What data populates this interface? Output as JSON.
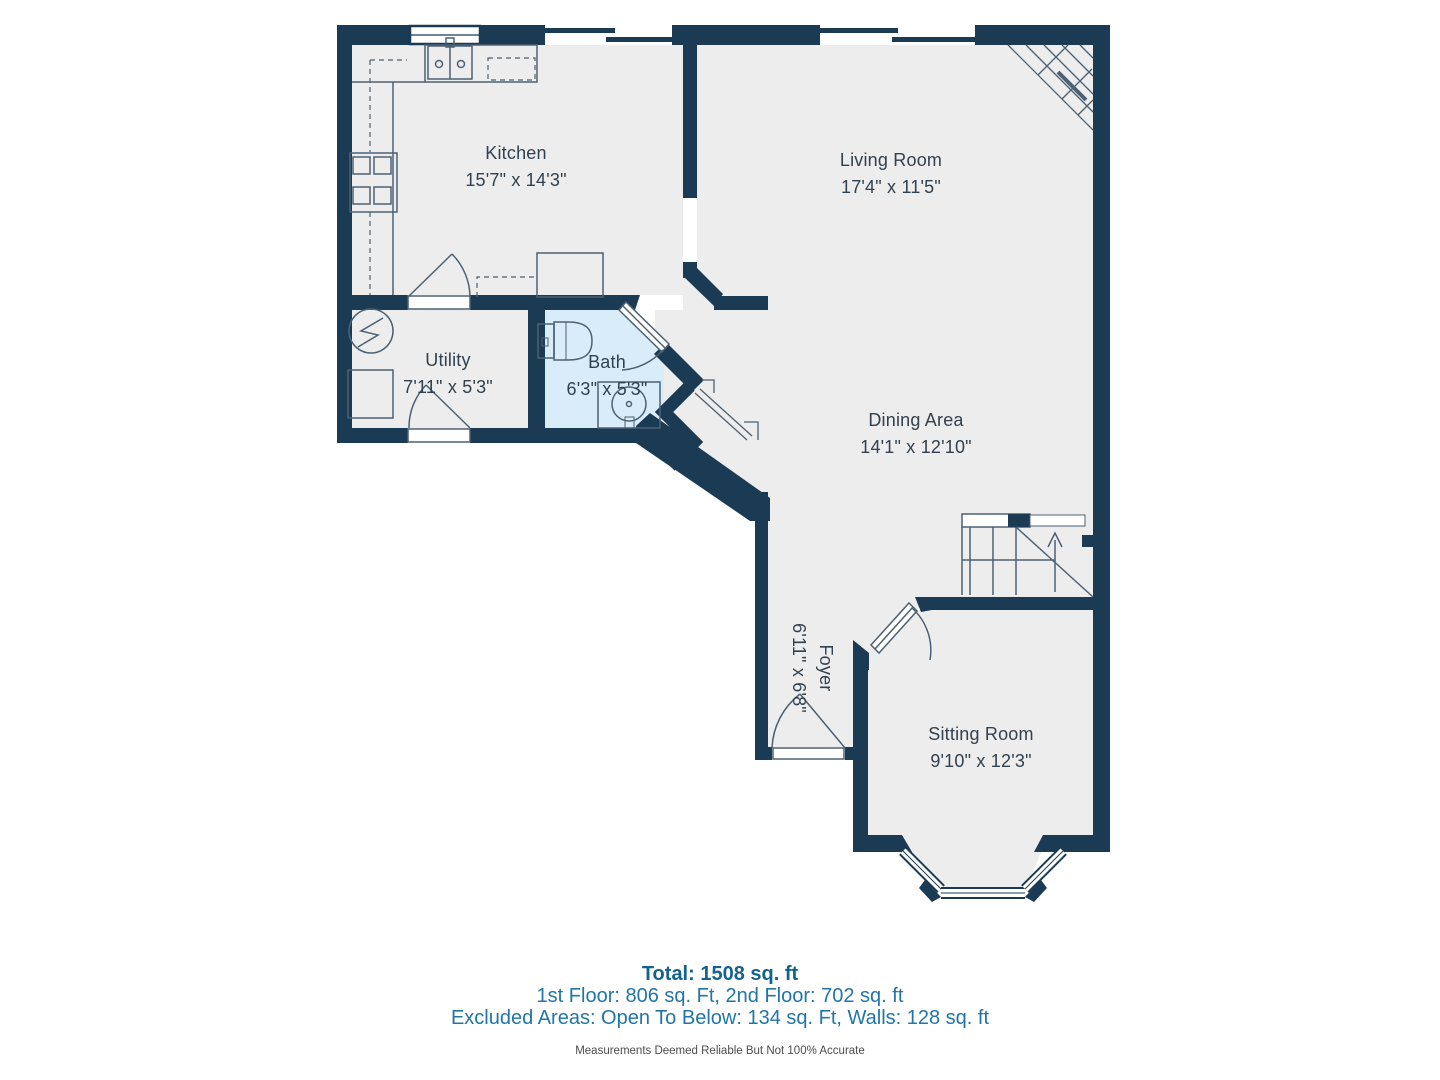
{
  "rooms": [
    {
      "id": "kitchen",
      "name": "Kitchen",
      "dims": "15'7\" x 14'3\""
    },
    {
      "id": "living",
      "name": "Living Room",
      "dims": "17'4\" x 11'5\""
    },
    {
      "id": "utility",
      "name": "Utility",
      "dims": "7'11\" x 5'3\""
    },
    {
      "id": "bath",
      "name": "Bath",
      "dims": "6'3\" x 5'3\""
    },
    {
      "id": "dining",
      "name": "Dining Area",
      "dims": "14'1\" x 12'10\""
    },
    {
      "id": "foyer",
      "name": "Foyer",
      "dims": "6'11\" x 6'8\""
    },
    {
      "id": "sitting",
      "name": "Sitting Room",
      "dims": "9'10\" x 12'3\""
    }
  ],
  "summary": {
    "total": "Total: 1508 sq. ft",
    "floors": "1st Floor: 806 sq. Ft, 2nd Floor: 702 sq. ft",
    "excluded": "Excluded Areas: Open To Below: 134 sq. Ft, Walls: 128 sq. ft",
    "disclaimer": "Measurements Deemed Reliable But Not 100% Accurate"
  },
  "colors": {
    "wall": "#1b3a54",
    "floor": "#ededee",
    "bath_floor": "#d8edf9",
    "fixture_line": "#4c6173",
    "label_text": "#31414f",
    "summary_total": "#15628e",
    "summary_text": "#2276a7"
  }
}
